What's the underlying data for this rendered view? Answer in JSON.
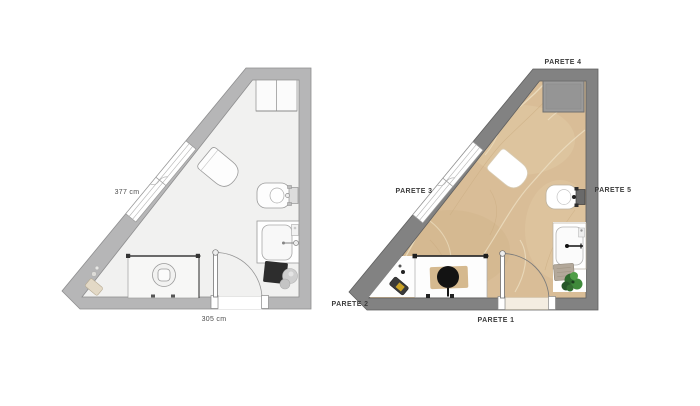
{
  "canvas": {
    "background": "#ffffff"
  },
  "plans": {
    "left": {
      "name": "empty bathroom floor plan (technical drawing)",
      "dim_diagonal": "377 cm",
      "dim_bottom": "305 cm",
      "colors": {
        "wall": "#b6b6b7",
        "wall_stroke": "#8e8e8f",
        "floor": "#f1f1f0",
        "fixture_stroke": "#9a9a9a",
        "dark_accent": "#2d2d2d"
      },
      "fixtures": [
        "wall-cabinet",
        "window",
        "wc",
        "bidet",
        "washbasin",
        "black-mat",
        "stool",
        "shower",
        "door"
      ]
    },
    "right": {
      "name": "furnished bathroom floor plan (material render)",
      "wall_labels": [
        "PARETE 1",
        "PARETE 2",
        "PARETE 3",
        "PARETE 4",
        "PARETE 5"
      ],
      "colors": {
        "wall": "#828282",
        "wall_stroke": "#5f5f5f",
        "floor_marble": "#d9bd97",
        "floor_vein_light": "#ecdfc2",
        "floor_vein_dark": "#c8aa7e",
        "plant_green": "#3f8a3b",
        "mat_gray": "#b3a89a",
        "stool_black": "#141414",
        "bin_label_yellow": "#c9a227"
      },
      "fixtures": [
        "wall-niche",
        "window",
        "wc",
        "bidet",
        "washbasin",
        "gray-mat",
        "plant",
        "shower",
        "round-stool",
        "waste-bin",
        "door"
      ]
    }
  }
}
